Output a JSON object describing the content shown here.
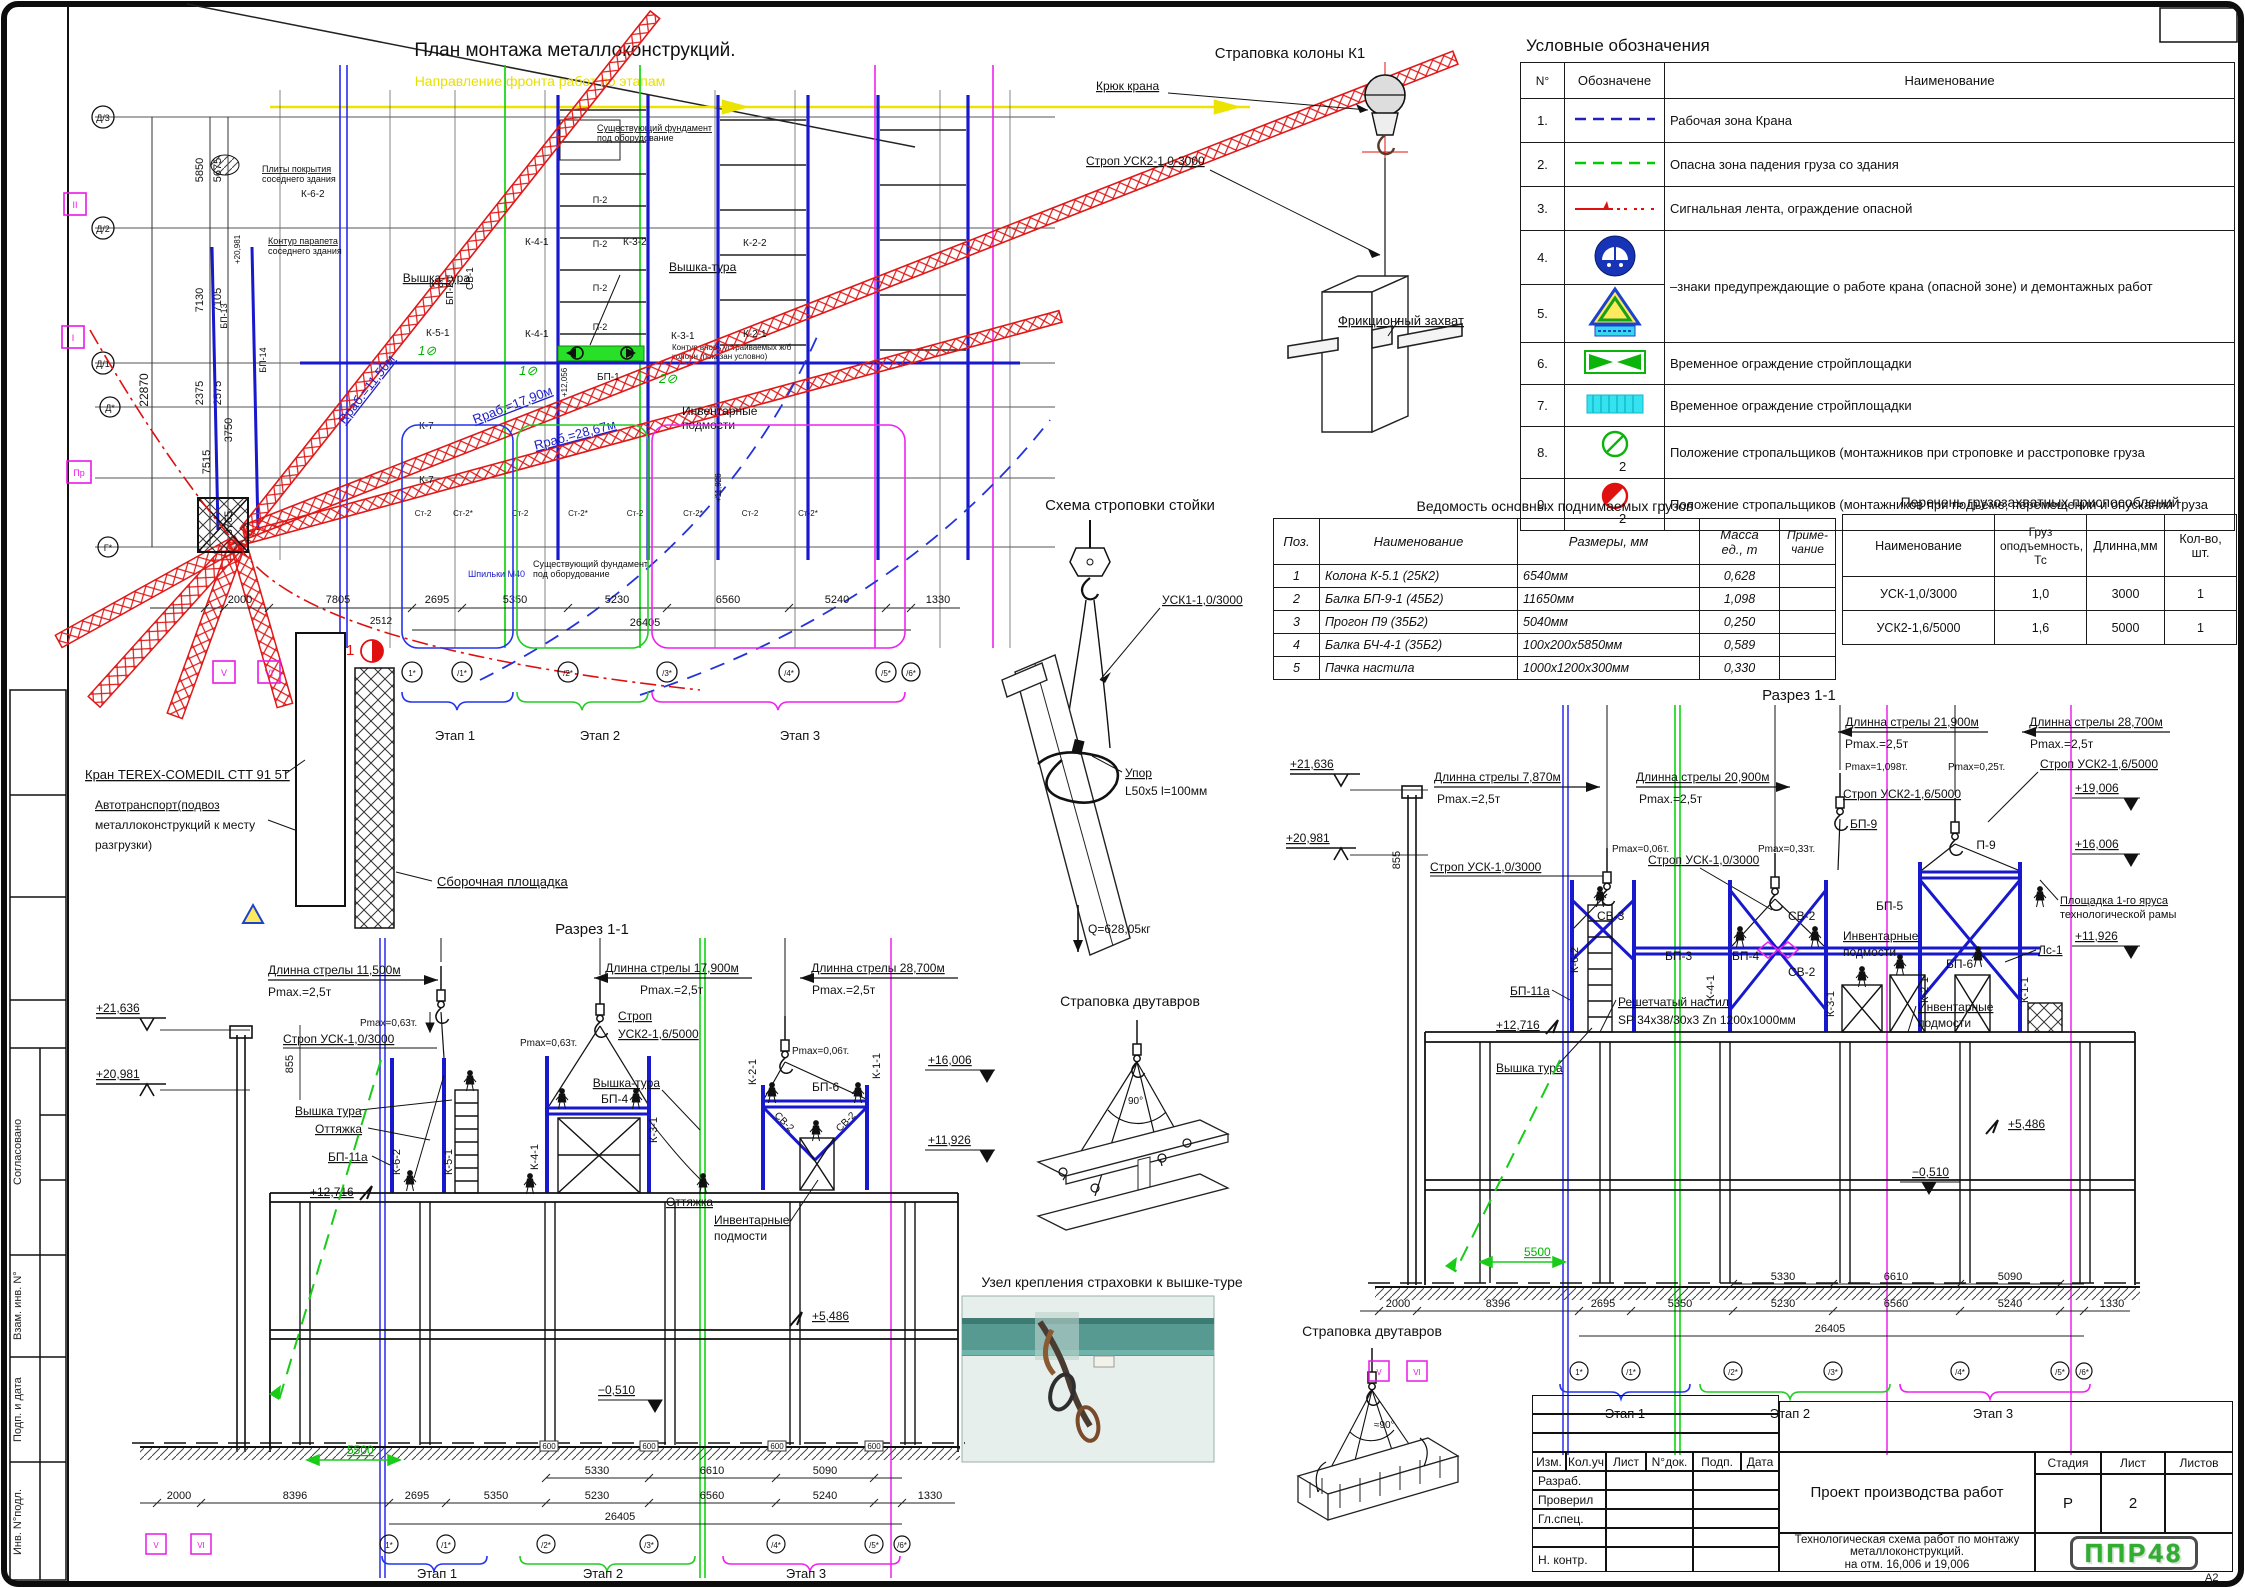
{
  "sheet": {
    "format": "А2",
    "side_labels": [
      "Согласовано",
      "Взам. инв. N°",
      "Подп. и дата",
      "Инв. N°подл."
    ]
  },
  "plan": {
    "title": "План монтажа металлоконструкций.",
    "direction": "Направление фронта работ по этапам",
    "axes_left": [
      "Д/3",
      "Д/2",
      "Д/1",
      "Д*",
      "Г*"
    ],
    "axes_left_sq": [
      "II",
      "I",
      "Пр"
    ],
    "dims_left": [
      "5850",
      "5675",
      "7130",
      "7105",
      "22870",
      "2375",
      "2575",
      "3750",
      "7515",
      "3765"
    ],
    "plates_1": "Плиты покрытия",
    "plates_2": "соседнего здания",
    "parapet_1": "Контур парапета",
    "parapet_2": "соседнего здания",
    "found_1": "Существующий фундамент",
    "found_2": "под оборудование",
    "found2_1": "Существующий фундамент",
    "found2_2": "под оборудование",
    "anchors": "Шпильки М40",
    "newcol_1": "Контур вновь устраиваемых ж/б",
    "newcol_2": "колонн (показан условно)",
    "radius_1": "Rраб.=11,50м",
    "radius_2": "Rраб.=17,90м",
    "radius_3": "Rраб.=28,67м",
    "mark_1": "1⊘",
    "mark_2": "1⊘",
    "mark_3": "2⊘",
    "members": {
      "k62": "К-6-2",
      "k61": "К-6-1",
      "k51": "К-5-1",
      "k41": "К-4-1",
      "k41b": "К-4-1",
      "k32": "К-3-2",
      "k31": "К-3-1",
      "k22": "К-2-2",
      "k21": "К-2-1",
      "k7": "К-7",
      "k7b": "К-7",
      "bp1": "БП-1",
      "bp2": "БП-2",
      "bp13": "БП-13",
      "bp14": "БП-14",
      "sv1": "СВ-1",
      "p2": "П-2"
    },
    "st2": "Ст-2",
    "st2s": "Ст-2*",
    "tag_1": "+12,056",
    "tag_2": "+11,926",
    "tag_3": "+20,981",
    "tower": "Вышка-тура",
    "tower2": "Вышка-тура",
    "inv_1": "Инвентарные",
    "inv_2": "подмости",
    "crane": "Кран TEREX-COMEDIL CTT 91 5T",
    "truck_1": "Автотранспорт(подвоз",
    "truck_2": "металлоконструкций к месту",
    "truck_3": "разгрузки)",
    "assembly": "Сборочная площадка",
    "cut_mark": "1",
    "dims_bottom": [
      "2000",
      "7805",
      "2512",
      "2695",
      "5350",
      "5230",
      "6560",
      "5240",
      "1330"
    ],
    "dim_total": "26405",
    "axes_bottom": [
      "V",
      "VI",
      "1*",
      "/1*",
      "/2*",
      "/3*",
      "/4*",
      "/5*",
      "/6*"
    ],
    "stages": [
      "Этап 1",
      "Этап 2",
      "Этап 3"
    ]
  },
  "legend": {
    "title": "Условные обозначения",
    "col_num": "N°",
    "col_sym": "Обозначене",
    "col_name": "Наименование",
    "r1n": "1.",
    "r1": "Рабочая зона Крана",
    "r2n": "2.",
    "r2": "Опасна зона падения груза со здания",
    "r3n": "3.",
    "r3": "Сигнальная лента, ограждение опасной",
    "r4n": "4.",
    "r5n": "5.",
    "r45": "–знаки предупреждающие о работе крана (опасной зоне) и демонтажных работ",
    "r6n": "6.",
    "r6": "Временное ограждение стройплощадки",
    "r7n": "7.",
    "r7": "Временное ограждение стройплощадки",
    "r8n": "8.",
    "r8": "Положение стропальщиков (монтажников  при   строповке и расстроповке груза",
    "r8b": "2",
    "r9n": "9.",
    "r9": "Положение стропальщиков (монтажников  при подъёме, перемещении и опускании груза",
    "r9b": "2"
  },
  "sling_column": {
    "title": "Страповка колоны К1",
    "hook": "Крюк крана",
    "sling": "Строп УСК2-1,0-3000",
    "grab": "Фрикционный захват"
  },
  "sling_stand": {
    "title": "Схема строповки стойки",
    "sling": "УСК1-1,0/3000",
    "stop1": "Упор",
    "stop2": "L50x5 l=100мм",
    "weight": "Q=628,05кг"
  },
  "loads_table": {
    "title": "Ведомость основных поднимаемых грузов",
    "h_pos": "Поз.",
    "h_name": "Наименование",
    "h_size": "Размеры, мм",
    "h_mass1": "Масса",
    "h_mass2": "ед., т",
    "h_note1": "Приме-",
    "h_note2": "чание",
    "rows": [
      [
        "1",
        "Колона К-5.1 (25К2)",
        "6540мм",
        "0,628"
      ],
      [
        "2",
        "Балка БП-9-1 (45Б2)",
        "11650мм",
        "1,098"
      ],
      [
        "3",
        "Прогон П9 (35Б2)",
        "5040мм",
        "0,250"
      ],
      [
        "4",
        "Балка БЧ-4-1 (35Б2)",
        "100х200х5850мм",
        "0,589"
      ],
      [
        "5",
        "Пачка настила",
        "1000х1200х300мм",
        "0,330"
      ]
    ]
  },
  "rigging_table": {
    "title": "Перечень грузозахватных приспособлений",
    "h_name": "Наименование",
    "h_cap1": "Груз",
    "h_cap2": "оподъемность,",
    "h_cap3": "Тс",
    "h_len": "Длинна,мм",
    "h_qty": "Кол-во, шт.",
    "rows": [
      [
        "УСК-1,0/3000",
        "1,0",
        "3000",
        "1"
      ],
      [
        "УСК2-1,6/5000",
        "1,6",
        "5000",
        "1"
      ]
    ]
  },
  "section_left": {
    "title": "Разрез 1-1",
    "elev1": "+21,636",
    "elev2": "+20,981",
    "dim855": "855",
    "boom1": "Длинна стрелы 11,500м",
    "boom2": "Длинна стрелы 17,900м",
    "boom3": "Длинна стрелы 28,700м",
    "pmax1": "Pmax.=2,5т",
    "pmax2": "Pmax.=2,5т",
    "pmax3": "Pmax.=2,5т",
    "pmax063a": "Pmax=0,63т.",
    "pmax063b": "Pmax=0,63т.",
    "pmax006": "Pmax=0,06т.",
    "sling1": "Строп УСК-1,0/3000",
    "sling2a": "Строп",
    "sling2b": "УСК2-1,6/5000",
    "tower1": "Вышка тура",
    "tower2": "Вышка-тура",
    "guy1": "Оттяжка",
    "guy2": "Оттяжка",
    "bp11a": "БП-11а",
    "elev12716": "+12,716",
    "k62": "К-6-2",
    "k51": "К-5-1",
    "k41": "К-4-1",
    "k31": "К-3-1",
    "k21": "К-2-1",
    "k11": "К-1-1",
    "bp4": "БП-4",
    "bp6": "БП-6",
    "sv2a": "СВ-2",
    "sv2b": "СВ-2",
    "elev16006": "+16,006",
    "elev11926": "+11,926",
    "elev5486": "+5,486",
    "elevm0510": "−0,510",
    "inv1": "Инвентарные",
    "inv2": "подмости",
    "dim5500": "5500",
    "foot": "600",
    "dims_upper": [
      "5330",
      "6610",
      "5090"
    ],
    "dims": [
      "2000",
      "8396",
      "2695",
      "5350",
      "5230",
      "6560",
      "5240",
      "1330"
    ],
    "total": "26405",
    "axes": [
      "V",
      "VI",
      "1*",
      "/1*",
      "/2*",
      "/3*",
      "/4*",
      "/5*",
      "/6*"
    ],
    "stages": [
      "Этап 1",
      "Этап 2",
      "Этап 3"
    ]
  },
  "section_right": {
    "title": "Разрез 1-1",
    "elev1": "+21,636",
    "elev2": "+20,981",
    "dim855": "855",
    "boom1": "Длинна стрелы 7,870м",
    "boom2": "Длинна стрелы 20,900м",
    "boom3": "Длинна стрелы 21,900м",
    "boom4": "Длинна стрелы 28,700м",
    "pmax1": "Pmax.=2,5т",
    "pmax2": "Pmax.=2,5т",
    "pmax3": "Pmax.=2,5т",
    "pmax4": "Pmax.=2,5т",
    "pmax006": "Pmax=0,06т.",
    "pmax033": "Pmax=0,33т.",
    "pmax1098": "Pmax=1,098т.",
    "pmax025": "Pmax=0,25т.",
    "sling1": "Строп УСК-1,0/3000",
    "sling2": "Строп УСК-1,0/3000",
    "sling3": "Строп УСК2-1,6/5000",
    "sling4": "Строп УСК2-1,6/5000",
    "bp9": "БП-9",
    "bp3": "БП-3",
    "bp4": "БП-4",
    "bp5": "БП-5",
    "bp6": "БП-6",
    "p9": "П-9",
    "sv3": "СВ-3",
    "sv2a": "СВ-2",
    "sv2b": "СВ-2",
    "k62": "К-6-2",
    "k41": "К-4-1",
    "k31": "К-3-1",
    "k21": "К-2-1",
    "k11": "К-1-1",
    "ls1": "Лс-1",
    "bp11a": "БП-11а",
    "elev12716": "+12,716",
    "tower": "Вышка тура",
    "grating1": "Решетчатый настил",
    "grating2": "SP 34х38/30х3 Zn 1200х1000мм",
    "inv1a": "Инвентарные",
    "inv1b": "подмости",
    "inv2a": "Инвентарные",
    "inv2b": "подмости",
    "platform1": "Площадка 1-го яруса",
    "platform2": "технологической рамы",
    "elev19006": "+19,006",
    "elev16006": "+16,006",
    "elev11926": "+11,926",
    "elev5486": "+5,486",
    "elevm0510": "−0,510",
    "dim5500": "5500",
    "dims_upper": [
      "5330",
      "6610",
      "5090"
    ],
    "dims": [
      "2000",
      "8396",
      "2695",
      "5350",
      "5230",
      "6560",
      "5240",
      "1330"
    ],
    "total": "26405",
    "axes": [
      "V",
      "VI",
      "1*",
      "/1*",
      "/2*",
      "/3*",
      "/4*",
      "/5*",
      "/6*"
    ],
    "stages": [
      "Этап 1",
      "Этап 2",
      "Этап 3"
    ]
  },
  "sling_beam": {
    "title": "Страповка двутавров",
    "angle": "90°"
  },
  "safety_node": {
    "title": "Узел крепления страховки к вышке-туре"
  },
  "sling_bundle": {
    "title": "Страповка двутавров",
    "angle": "≈90°"
  },
  "titleblock": {
    "c1": "Изм.",
    "c2": "Кол.уч",
    "c3": "Лист",
    "c4": "N°док.",
    "c5": "Подп.",
    "c6": "Дата",
    "r1": "Разраб.",
    "r2": "Проверил",
    "r3": "Гл.спец.",
    "r4": "Н. контр.",
    "doc": "Проект производства работ",
    "sub1": "Технологическая схема работ по монтажу",
    "sub2": "металлоконструкций.",
    "sub3": "на отм. 16,006 и 19,006",
    "stadia": "Стадия",
    "list": "Лист",
    "listov": "Листов",
    "stadia_v": "Р",
    "list_v": "2",
    "logo": "ППР48"
  }
}
